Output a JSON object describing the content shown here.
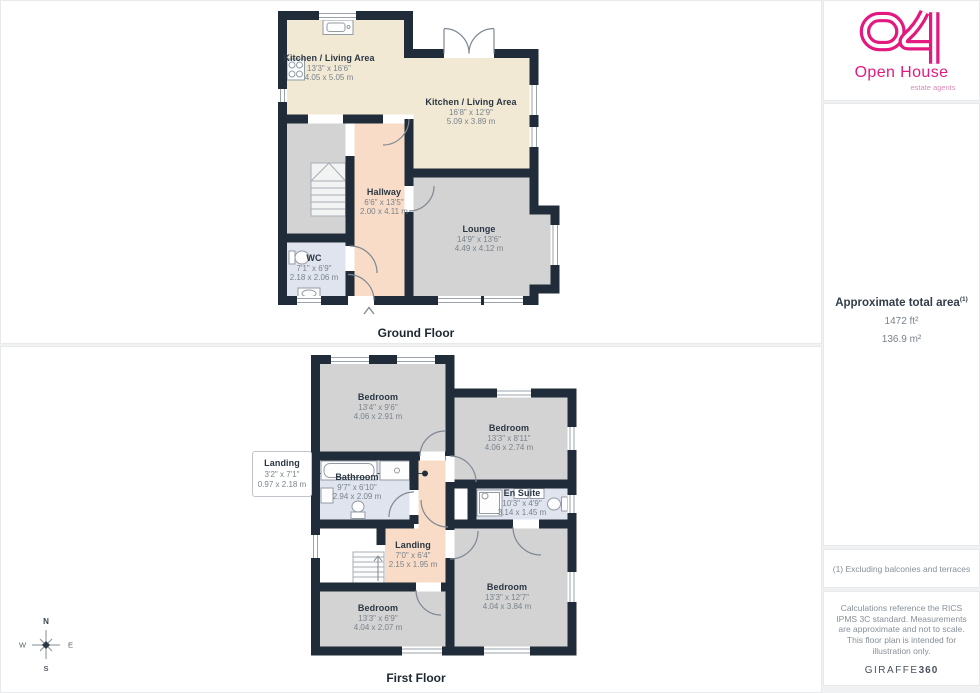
{
  "page": {
    "background": "#f0f1f2",
    "wall_color": "#212c3a",
    "accent_pink": "#e3197f",
    "room_colors": {
      "kitchen": "#f2e9d5",
      "bedroom_lounge": "#d3d3d3",
      "hall_landing": "#f8dcc7",
      "bath_wc": "#dfe4ee"
    }
  },
  "ground_floor": {
    "title": "Ground Floor",
    "rooms": [
      {
        "name": "Kitchen / Living Area",
        "imperial": "13'3\" x 16'6\"",
        "metric": "4.05 x 5.05 m"
      },
      {
        "name": "Kitchen / Living Area",
        "imperial": "16'8\" x 12'9\"",
        "metric": "5.09 x 3.89 m"
      },
      {
        "name": "Hallway",
        "imperial": "6'6\" x 13'5\"",
        "metric": "2.00 x 4.11 m"
      },
      {
        "name": "Lounge",
        "imperial": "14'9\" x 13'6\"",
        "metric": "4.49 x 4.12 m"
      },
      {
        "name": "WC",
        "imperial": "7'1\" x 6'9\"",
        "metric": "2.18 x 2.06 m"
      }
    ]
  },
  "first_floor": {
    "title": "First Floor",
    "rooms": [
      {
        "name": "Bedroom",
        "imperial": "13'4\" x 9'6\"",
        "metric": "4.06 x 2.91 m"
      },
      {
        "name": "Bedroom",
        "imperial": "13'3\" x 8'11\"",
        "metric": "4.06 x 2.74 m"
      },
      {
        "name": "Landing",
        "imperial": "3'2\" x 7'1\"",
        "metric": "0.97 x 2.18 m"
      },
      {
        "name": "Bathroom",
        "imperial": "9'7\" x 6'10\"",
        "metric": "2.94 x 2.09 m"
      },
      {
        "name": "En Suite",
        "imperial": "10'3\" x 4'9\"",
        "metric": "3.14 x 1.45 m"
      },
      {
        "name": "Landing",
        "imperial": "7'0\" x 6'4\"",
        "metric": "2.15 x 1.95 m"
      },
      {
        "name": "Bedroom",
        "imperial": "13'3\" x 6'9\"",
        "metric": "4.04 x 2.07 m"
      },
      {
        "name": "Bedroom",
        "imperial": "13'3\" x 12'7\"",
        "metric": "4.04 x 3.84 m"
      }
    ]
  },
  "compass": {
    "north": "N",
    "east": "E",
    "south": "S",
    "west": "W"
  },
  "sidebar": {
    "logo": {
      "brand": "Open House",
      "tagline": "estate agents"
    },
    "area": {
      "heading": "Approximate total area",
      "footnote_marker": "(1)",
      "imperial": "1472 ft²",
      "metric": "136.9 m²"
    },
    "footnote": "(1) Excluding balconies and terraces",
    "disclaimer": "Calculations reference the RICS IPMS 3C standard. Measurements are approximate and not to scale. This floor plan is intended for illustration only.",
    "provider": {
      "name": "GIRAFFE",
      "suffix": "360"
    }
  }
}
